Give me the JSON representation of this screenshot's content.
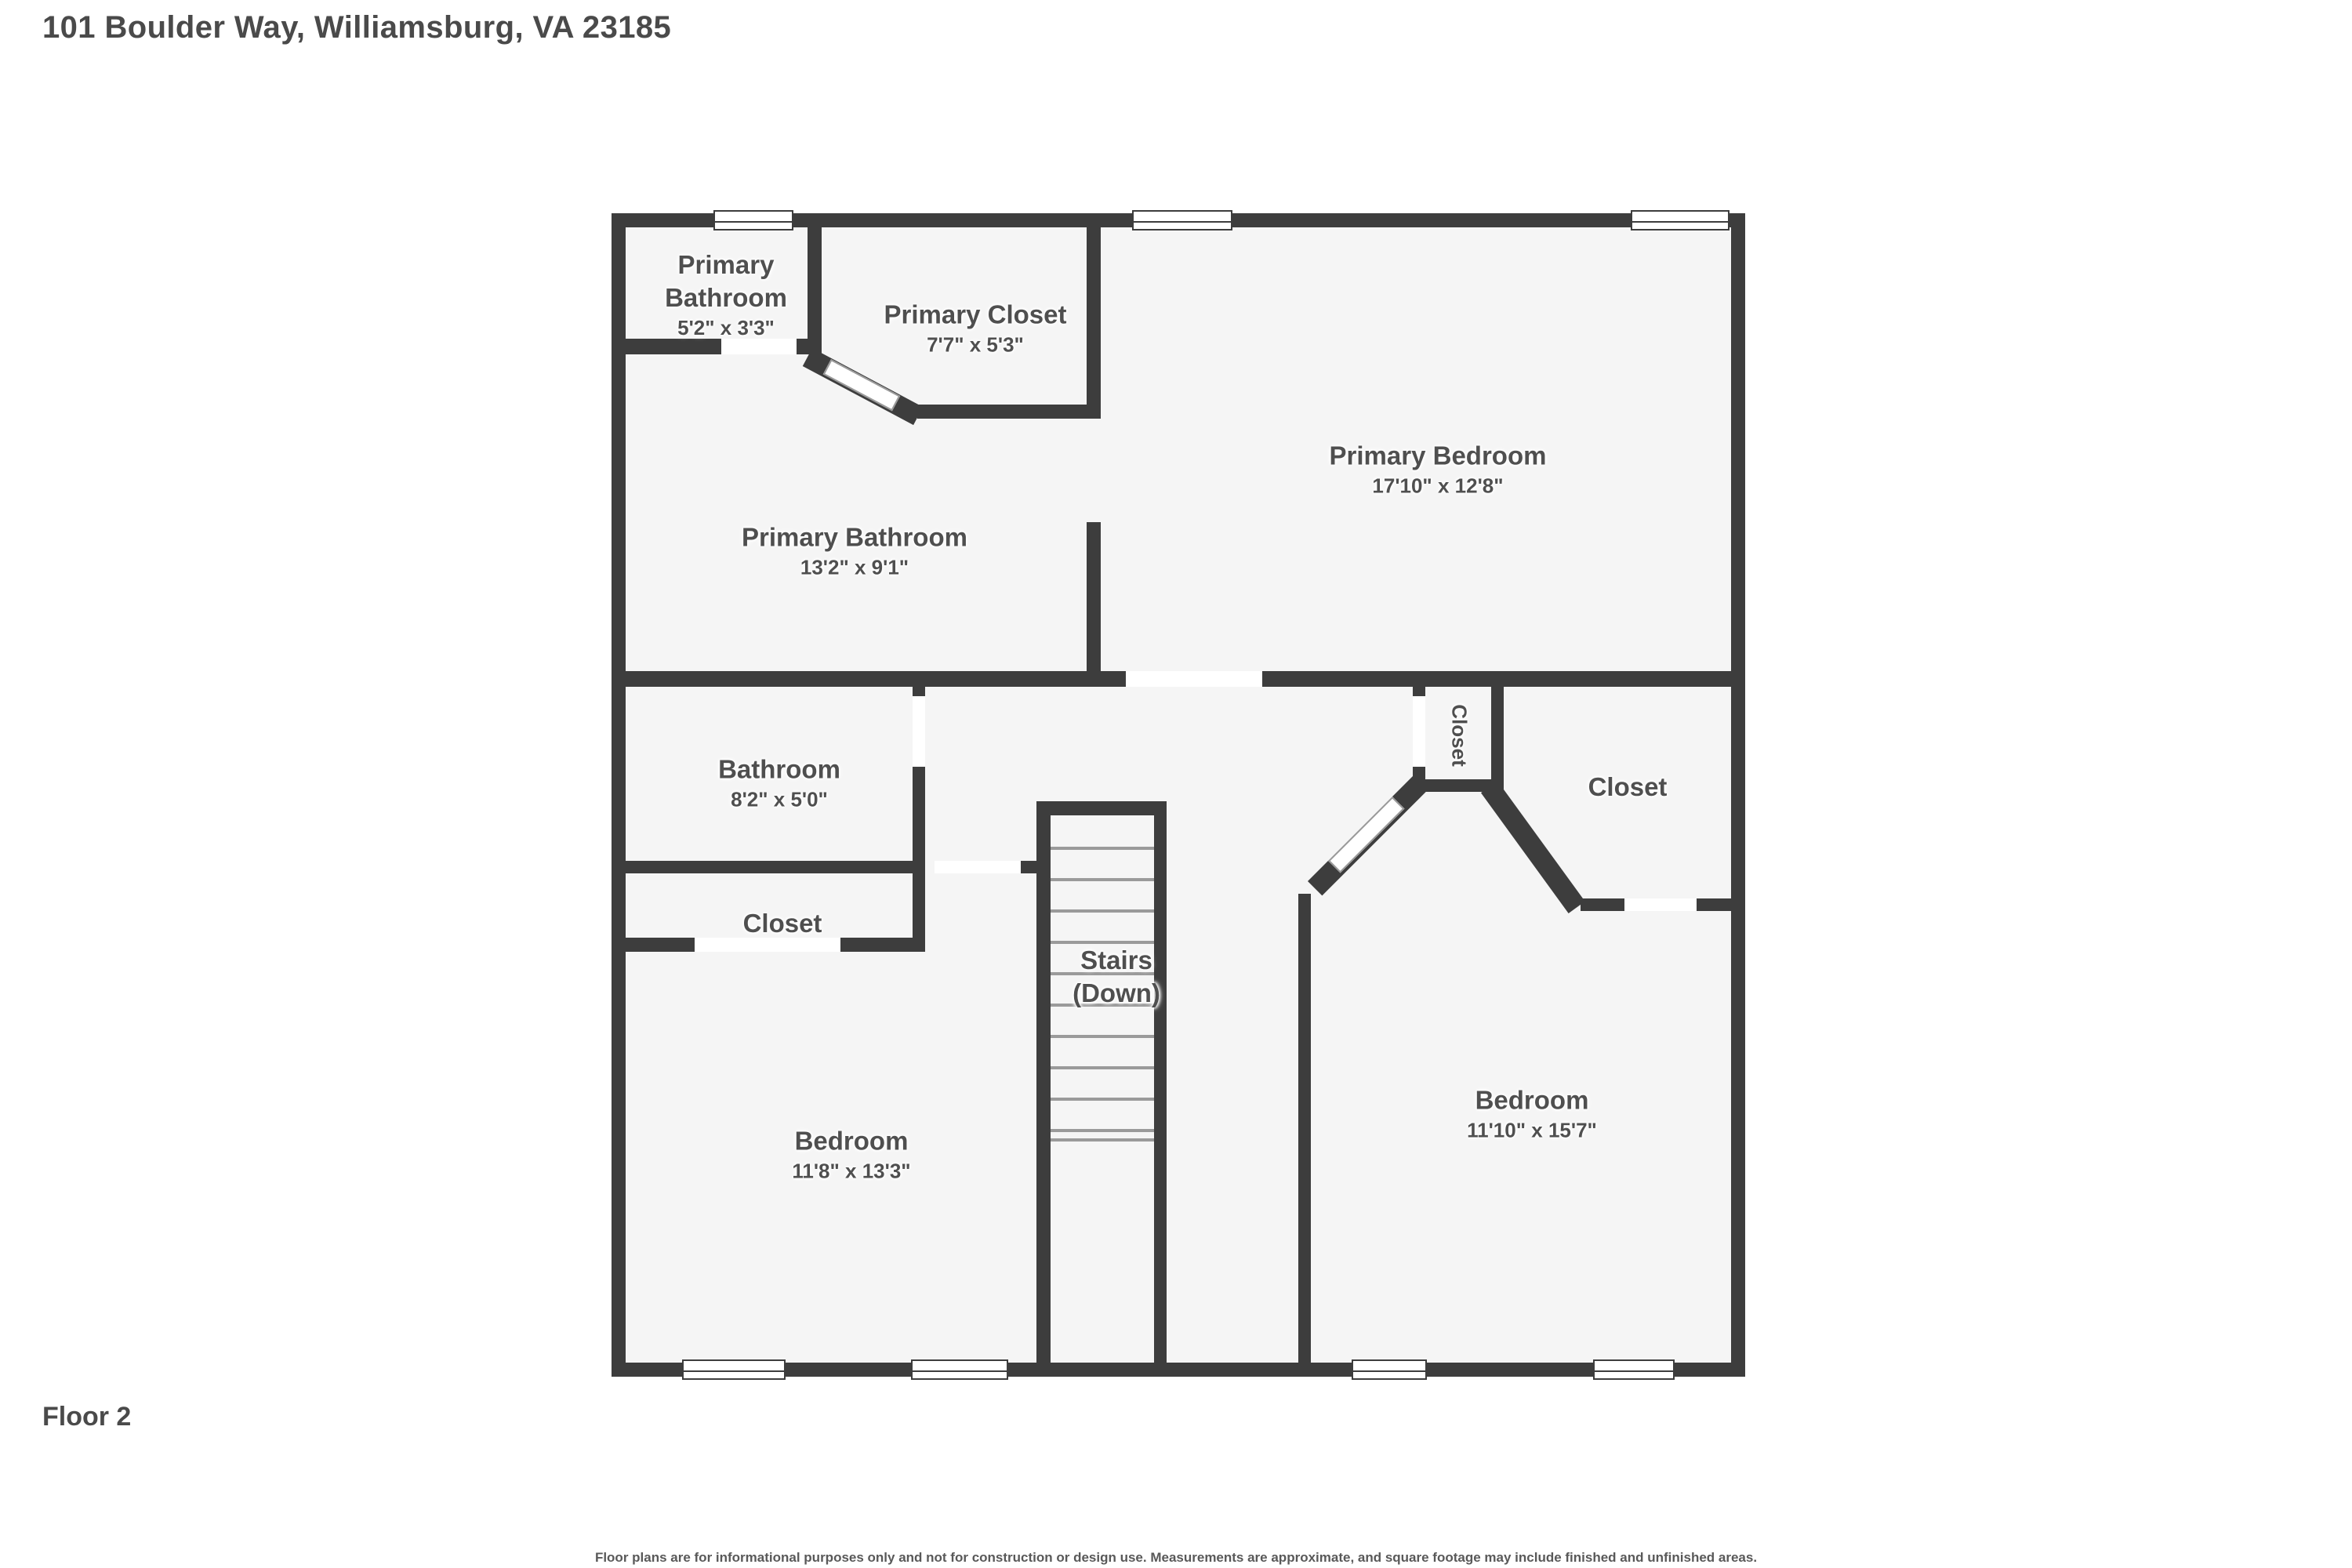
{
  "header": {
    "title": "101 Boulder Way, Williamsburg, VA 23185"
  },
  "footer": {
    "floor_label": "Floor 2",
    "disclaimer": "Floor plans are for informational purposes only and not for construction or design use. Measurements are approximate, and square footage may include finished and unfinished areas."
  },
  "colors": {
    "wall": "#3d3d3d",
    "room_fill": "#f5f5f5",
    "label_text": "#4f4f4f",
    "background": "#ffffff"
  },
  "rooms": {
    "primary_bathroom_small": {
      "line1": "Primary",
      "line2": "Bathroom",
      "dims": "5'2\" x 3'3\""
    },
    "primary_closet": {
      "name": "Primary Closet",
      "dims": "7'7\" x 5'3\""
    },
    "primary_bedroom": {
      "name": "Primary Bedroom",
      "dims": "17'10\" x 12'8\""
    },
    "primary_bathroom": {
      "name": "Primary Bathroom",
      "dims": "13'2\" x 9'1\""
    },
    "bathroom": {
      "name": "Bathroom",
      "dims": "8'2\" x 5'0\""
    },
    "closet_hall": {
      "name": "Closet"
    },
    "closet_narrow": {
      "name": "Closet"
    },
    "closet_right": {
      "name": "Closet"
    },
    "stairs": {
      "name": "Stairs",
      "direction": "(Down)"
    },
    "bedroom_left": {
      "name": "Bedroom",
      "dims": "11'8\" x 13'3\""
    },
    "bedroom_right": {
      "name": "Bedroom",
      "dims": "11'10\" x 15'7\""
    }
  }
}
